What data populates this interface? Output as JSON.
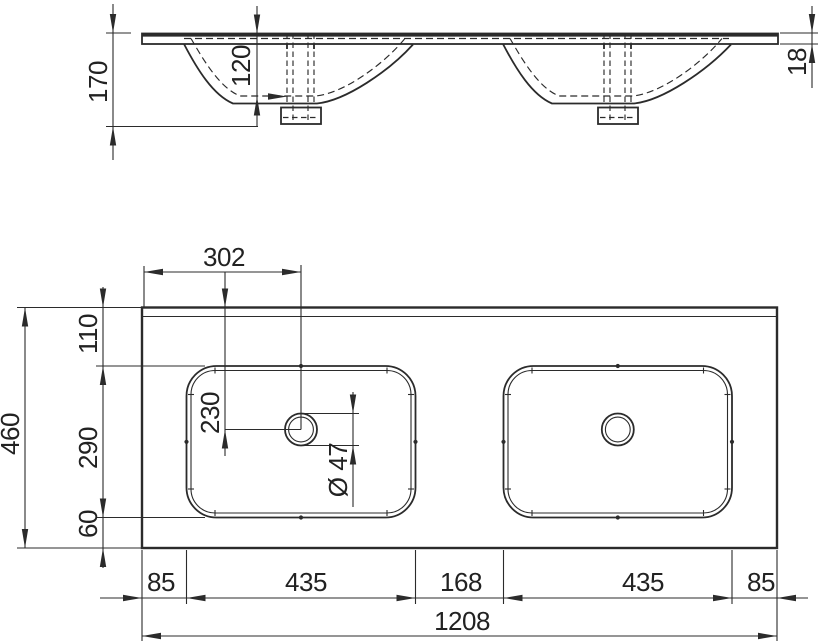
{
  "drawing": {
    "kind": "washbasin-technical-drawing",
    "colors": {
      "line": "#2b2b2b",
      "text": "#222222",
      "background": "#ffffff"
    }
  },
  "views": {
    "elevation": {
      "dims": {
        "total_height": "170",
        "basin_depth": "120",
        "slab_thickness": "18"
      }
    },
    "plan": {
      "dims": {
        "drain_left_offset": "302",
        "back_offset": "110",
        "drain_back_offset": "230",
        "basin_inner_depth": "290",
        "front_offset": "60",
        "total_depth": "460",
        "drain_diameter": "Ø 47"
      },
      "bottom_chain": {
        "left_margin": "85",
        "left_basin_width": "435",
        "center_gap": "168",
        "right_basin_width": "435",
        "right_margin": "85",
        "overall_width": "1208"
      }
    }
  }
}
